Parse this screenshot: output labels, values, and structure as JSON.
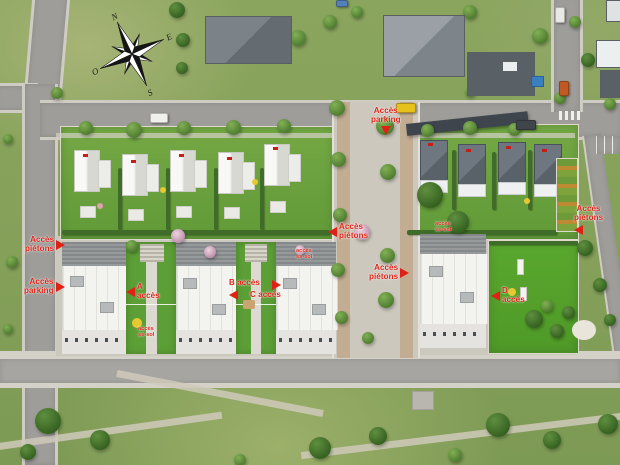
{
  "plan": {
    "type": "residential-masterplan-aerial-view",
    "colors": {
      "label_red": "#e02115",
      "grass": "#84a059",
      "lawn": "#61a038",
      "road": "#9e9d99",
      "sidewalk": "#d4d1c8",
      "roof_white": "#f3f3ef",
      "roof_dark": "#596269",
      "tan_path": "#bfa88b"
    }
  },
  "compass": {
    "n": "N",
    "e": "E",
    "s": "S",
    "o": "O"
  },
  "labels": [
    {
      "id": "acces-parking-top",
      "lines": [
        "Accès",
        "parking"
      ],
      "variant": "tri-down",
      "x": 371,
      "y": 107
    },
    {
      "id": "acces-pietons-left",
      "lines": [
        "Accès",
        "piétons"
      ],
      "variant": "tri-right",
      "x": 25,
      "y": 236
    },
    {
      "id": "acces-parking-left",
      "lines": [
        "Accès",
        "parking"
      ],
      "variant": "tri-right",
      "x": 24,
      "y": 278
    },
    {
      "id": "acces-pietons-mid-left",
      "lines": [
        "Accès",
        "piétons"
      ],
      "variant": "tri-left",
      "x": 328,
      "y": 223
    },
    {
      "id": "acces-pietons-mid-right",
      "lines": [
        "Accès",
        "piétons"
      ],
      "variant": "tri-right",
      "x": 369,
      "y": 264
    },
    {
      "id": "acces-pietons-right",
      "lines": [
        "Accès",
        "piétons"
      ],
      "variant": "tri-below-left",
      "x": 574,
      "y": 205
    },
    {
      "id": "acces-hall-a",
      "lines": [
        "A",
        "accès"
      ],
      "variant": "tri-left",
      "x": 126,
      "y": 283
    },
    {
      "id": "acces-hall-b",
      "lines": [
        "B accès"
      ],
      "variant": "tri-below-left",
      "x": 229,
      "y": 279
    },
    {
      "id": "acces-hall-c",
      "lines": [
        "C accès"
      ],
      "variant": "tri-above-right",
      "x": 250,
      "y": 280
    },
    {
      "id": "acces-hall-d",
      "lines": [
        "D",
        "accès"
      ],
      "variant": "tri-left",
      "x": 491,
      "y": 287
    },
    {
      "id": "acces-ss-sol-1",
      "small": true,
      "lines": [
        "accès",
        "ss-sol"
      ],
      "variant": "plain",
      "x": 138,
      "y": 326
    },
    {
      "id": "acces-ss-sol-2",
      "small": true,
      "lines": [
        "accès",
        "ss-sol"
      ],
      "variant": "plain",
      "x": 296,
      "y": 248
    },
    {
      "id": "acces-ss-sol-3",
      "small": true,
      "lines": [
        "accès",
        "ss-sol"
      ],
      "variant": "plain",
      "x": 435,
      "y": 221
    }
  ]
}
